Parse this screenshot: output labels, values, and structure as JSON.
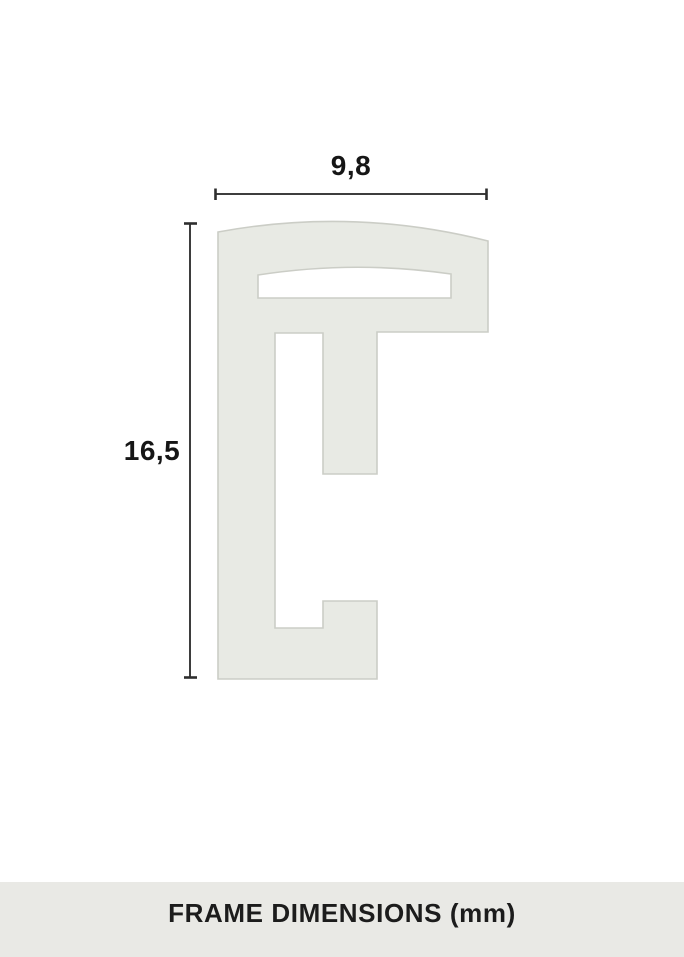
{
  "diagram": {
    "title": "Frame profile cross-section technical drawing",
    "width_label": "9,8",
    "height_label": "16,5",
    "width_mm": 9.8,
    "height_mm": 16.5,
    "unit": "mm",
    "caption": "FRAME DIMENSIONS (mm)"
  },
  "colors": {
    "background": "#ffffff",
    "profile_fill": "#e8eae4",
    "profile_stroke": "#cbcdc6",
    "dimension_line": "#3d3d3d",
    "label_text": "#161616",
    "caption_band": "#e9e9e5",
    "caption_text": "#1c1c1c"
  }
}
